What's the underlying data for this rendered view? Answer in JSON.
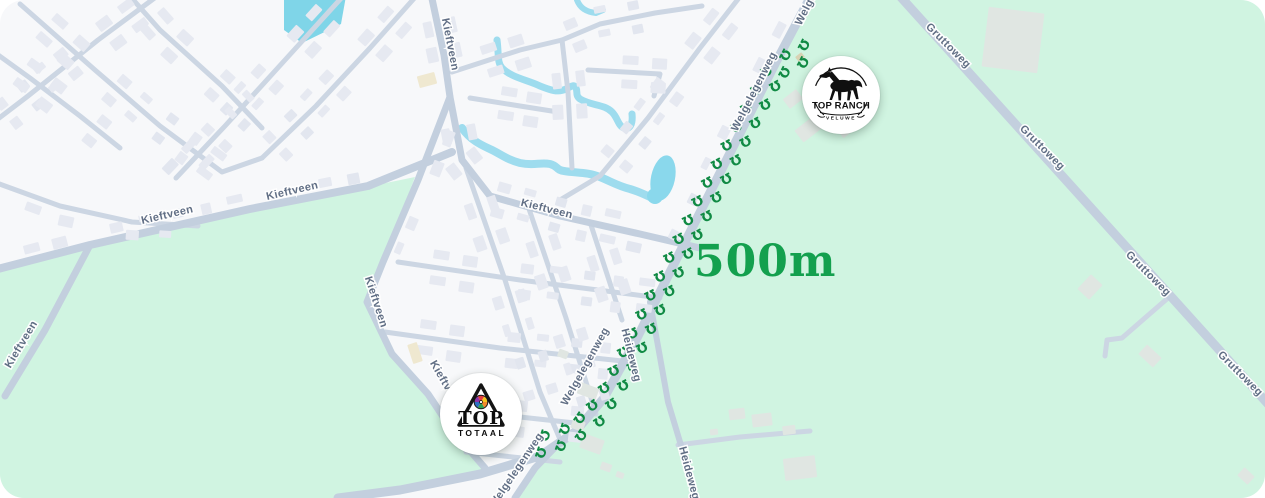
{
  "map": {
    "distance_label": "500m",
    "colors": {
      "field_green": "#d0f4e1",
      "residential": "#f7f8fa",
      "road": "#c3cfde",
      "road_minor": "#ccd6e3",
      "water": "#9edcee",
      "pond": "#82d6e9",
      "building": "#e6e9f1",
      "building_green_area": "#e0e6e2",
      "street_label": "#5d6b82",
      "trail_green": "#108a44",
      "distance_green": "#13a04e"
    },
    "markers": {
      "top_ranch": {
        "title": "TOP RANCH",
        "subtitle": "VELUWE",
        "icon": "horse-icon",
        "x": 841,
        "y": 95
      },
      "top_totaal": {
        "line1": "TOP",
        "line2": "TOTAAL",
        "icon": "triangle-pinwheel-icon",
        "x": 481,
        "y": 414
      }
    },
    "street_labels": [
      {
        "name": "Kieftveen",
        "x": 447,
        "y": 45,
        "rot": 79
      },
      {
        "name": "Kieftveen",
        "x": 168,
        "y": 218,
        "rot": -13
      },
      {
        "name": "Kieftveen",
        "x": 293,
        "y": 194,
        "rot": -13
      },
      {
        "name": "Kieftveen",
        "x": 546,
        "y": 212,
        "rot": 14
      },
      {
        "name": "Kieftveen",
        "x": 373,
        "y": 303,
        "rot": 72
      },
      {
        "name": "Kieftveen",
        "x": 24,
        "y": 346,
        "rot": -59
      },
      {
        "name": "Kieftveen",
        "x": 443,
        "y": 386,
        "rot": 60
      },
      {
        "name": "Gruttoweg",
        "x": 946,
        "y": 48,
        "rot": 45
      },
      {
        "name": "Gruttoweg",
        "x": 1040,
        "y": 150,
        "rot": 45
      },
      {
        "name": "Gruttoweg",
        "x": 1146,
        "y": 276,
        "rot": 45
      },
      {
        "name": "Gruttoweg",
        "x": 1238,
        "y": 376,
        "rot": 45
      },
      {
        "name": "Welgelegenweg",
        "x": 801,
        "y": 26,
        "rot": -63,
        "anchor": "start"
      },
      {
        "name": "Welgelegenweg",
        "x": 757,
        "y": 93,
        "rot": -63
      },
      {
        "name": "Welgelegenweg",
        "x": 588,
        "y": 368,
        "rot": -61
      },
      {
        "name": "Welgelegenweg",
        "x": 519,
        "y": 472,
        "rot": -56
      },
      {
        "name": "Heideweg",
        "x": 628,
        "y": 356,
        "rot": 76
      },
      {
        "name": "Heideweg",
        "x": 686,
        "y": 474,
        "rot": 75
      }
    ],
    "route": {
      "from": "top_ranch",
      "to": "top_totaal",
      "trail_icon": "horseshoe-icon",
      "waypoints": [
        [
          806,
          52
        ],
        [
          776,
          68
        ],
        [
          752,
          112
        ],
        [
          728,
          158
        ],
        [
          704,
          204
        ],
        [
          681,
          250
        ],
        [
          658,
          296
        ],
        [
          636,
          342
        ],
        [
          614,
          386
        ],
        [
          592,
          418
        ],
        [
          566,
          436
        ],
        [
          536,
          446
        ]
      ],
      "hoof_spacing": 21,
      "hoof_offset": 7.5
    }
  }
}
